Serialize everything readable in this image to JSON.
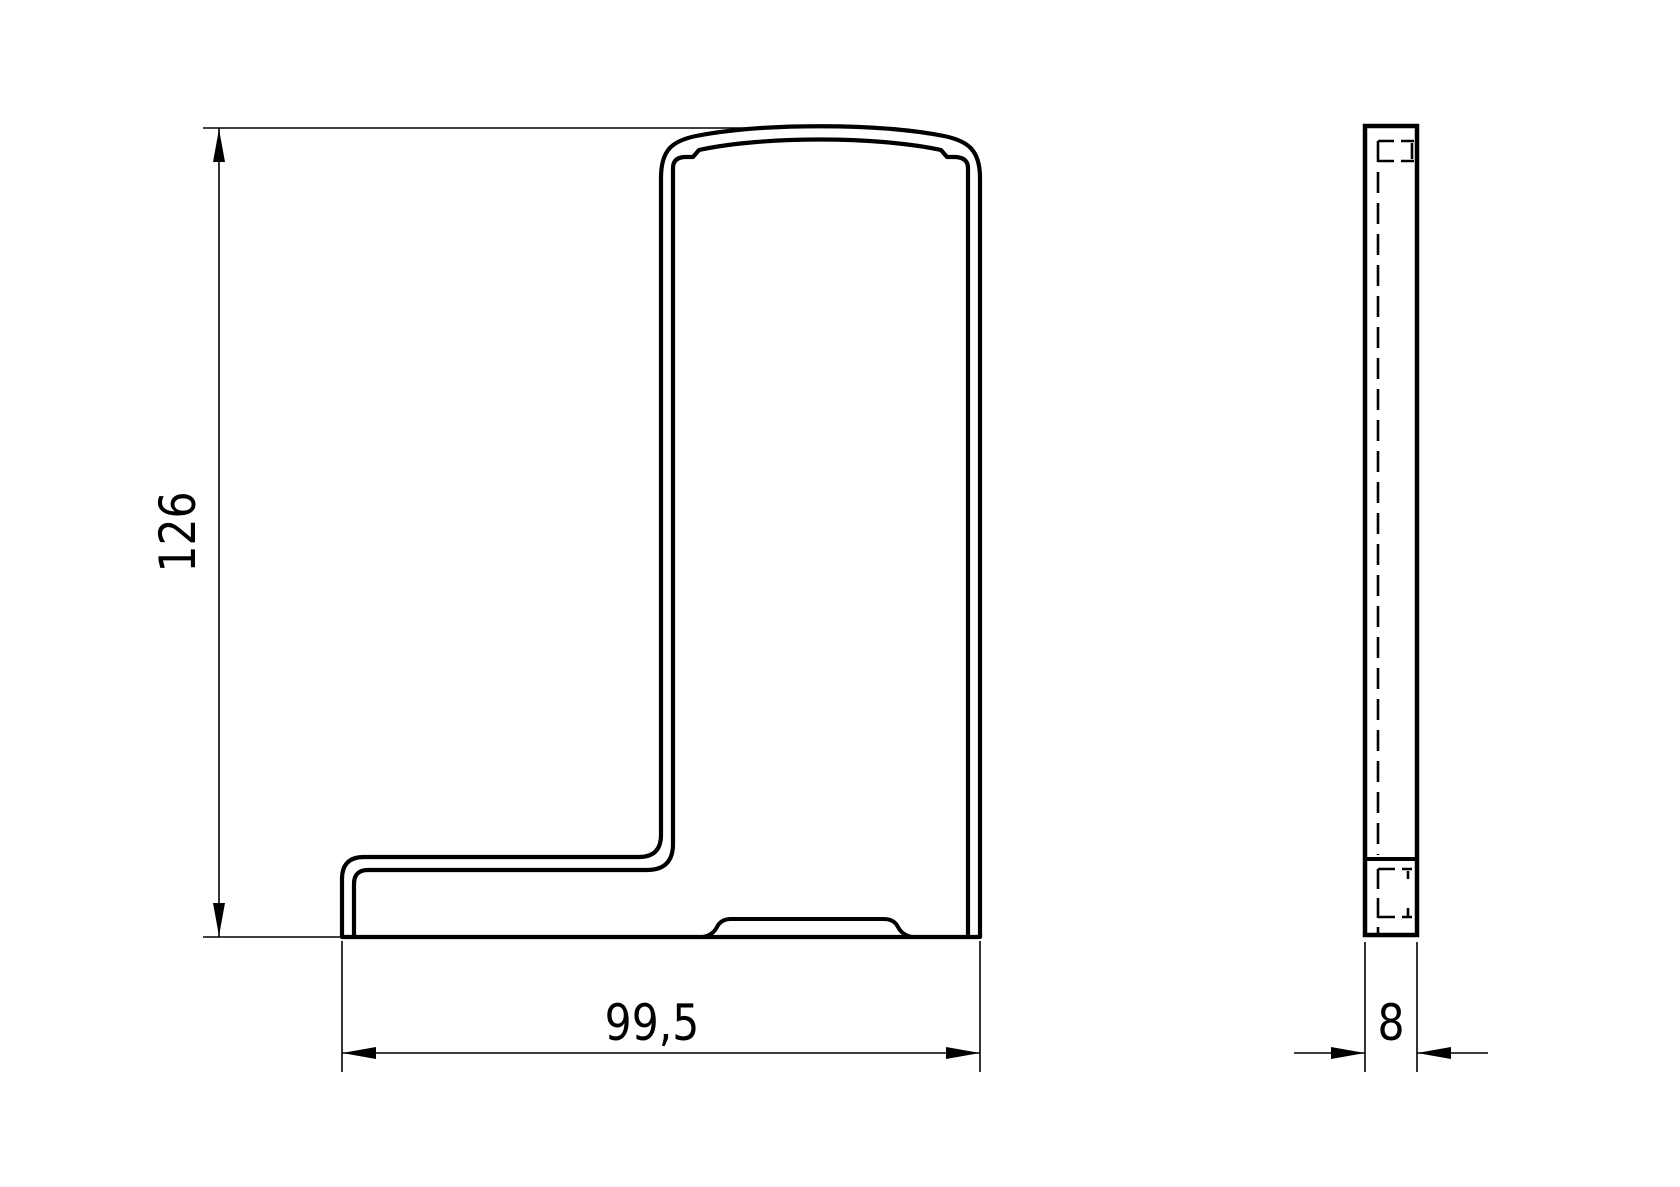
{
  "drawing": {
    "background_color": "#ffffff",
    "line_color": "#000000",
    "dimensions": {
      "height": "126",
      "width": "99,5",
      "thickness": "8"
    }
  }
}
